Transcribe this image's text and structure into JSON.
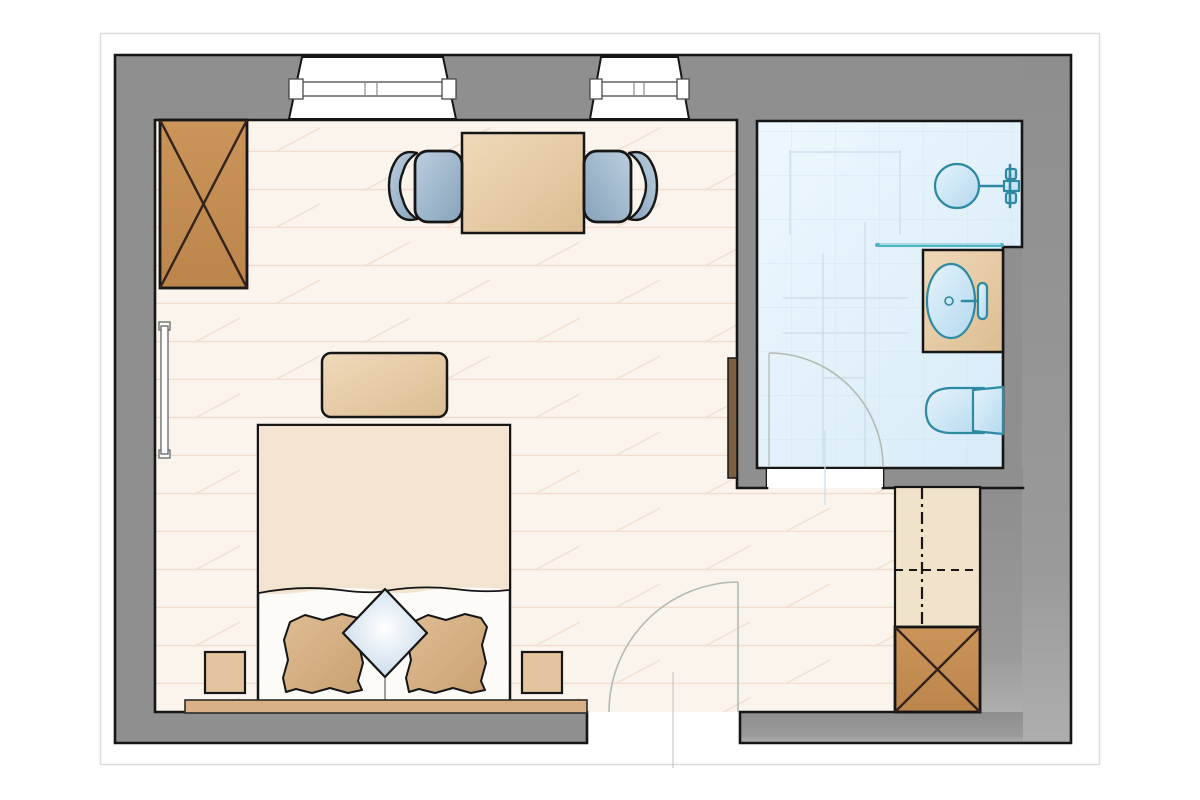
{
  "diagram": {
    "type": "floor-plan",
    "view": "top-down architectural plan",
    "text_labels": [],
    "rooms": [
      {
        "name": "bedroom",
        "floor": "light wood planks",
        "position": "left"
      },
      {
        "name": "ensuite-bathroom",
        "floor": "light blue tile",
        "position": "top-right"
      },
      {
        "name": "closet-nook",
        "floor": "light wood planks",
        "position": "bottom-right"
      }
    ],
    "openings": [
      {
        "name": "window-large",
        "wall": "top",
        "count": 1
      },
      {
        "name": "window-small",
        "wall": "top",
        "count": 1
      },
      {
        "name": "entry-door",
        "wall": "bottom",
        "swing": "inward-left"
      },
      {
        "name": "bathroom-door",
        "wall": "bathroom-bottom",
        "swing": "into-bathroom"
      }
    ],
    "furniture": [
      {
        "name": "wardrobe-crossed",
        "room": "bedroom",
        "symbol": "rectangle with X"
      },
      {
        "name": "wall-mirror",
        "room": "bedroom",
        "position": "left wall"
      },
      {
        "name": "dining-table",
        "room": "bedroom",
        "seats": 2
      },
      {
        "name": "chair-left",
        "room": "bedroom"
      },
      {
        "name": "chair-right",
        "room": "bedroom"
      },
      {
        "name": "bench",
        "room": "bedroom",
        "position": "foot of bed"
      },
      {
        "name": "double-bed",
        "room": "bedroom",
        "pillows": 3
      },
      {
        "name": "nightstand-left",
        "room": "bedroom"
      },
      {
        "name": "nightstand-right",
        "room": "bedroom"
      },
      {
        "name": "headboard",
        "room": "bedroom",
        "position": "bottom wall"
      },
      {
        "name": "shelf-unit",
        "room": "closet-nook",
        "symbol": "dashed rod lines"
      },
      {
        "name": "cabinet-crossed",
        "room": "closet-nook",
        "symbol": "square with X"
      },
      {
        "name": "sliding-door-panel",
        "room": "bedroom",
        "position": "partition wall"
      }
    ],
    "fixtures": [
      {
        "name": "shower-head",
        "room": "ensuite-bathroom"
      },
      {
        "name": "shower-mixer",
        "room": "ensuite-bathroom"
      },
      {
        "name": "glass-partition",
        "room": "ensuite-bathroom"
      },
      {
        "name": "vanity-sink",
        "room": "ensuite-bathroom"
      },
      {
        "name": "toilet",
        "room": "ensuite-bathroom"
      }
    ]
  },
  "palette": {
    "paperBorder": "#dcdcdc",
    "wall": "#8f8f8f",
    "wallLight": "#adadad",
    "outline": "#161616",
    "floorBase": "#fbf4ed",
    "floorLine": "#f2dccd",
    "bathFloor1": "#eef7fd",
    "bathFloor2": "#d7ebf8",
    "tile": "#cde4f3",
    "tan1": "#efd9ba",
    "tan2": "#e3c49e",
    "brown1": "#cd945f",
    "brownTop": "#cb9459",
    "brownBot": "#bc854b",
    "brownDark": "#33231a",
    "chair1": "#bccfde",
    "chair2": "#86a2bb",
    "fixtureStroke": "#2e89a3",
    "fixture1": "#e6f3fb",
    "fixture2": "#b3d9ef",
    "glass": "#4fb3c6",
    "pillow1": "#dfbc93",
    "pillow2": "#c9a272",
    "bedBase": "#fdfbf7",
    "blanket": "#f3e3d1",
    "headboard": "#d9b186",
    "shelf": "#f0e2cb",
    "doorArc": "#b3bab3",
    "ghost": "#c8dcea",
    "darkDoor": "#7d5f41",
    "diamond1": "#ffffff",
    "diamond2": "#c2d6e9"
  }
}
